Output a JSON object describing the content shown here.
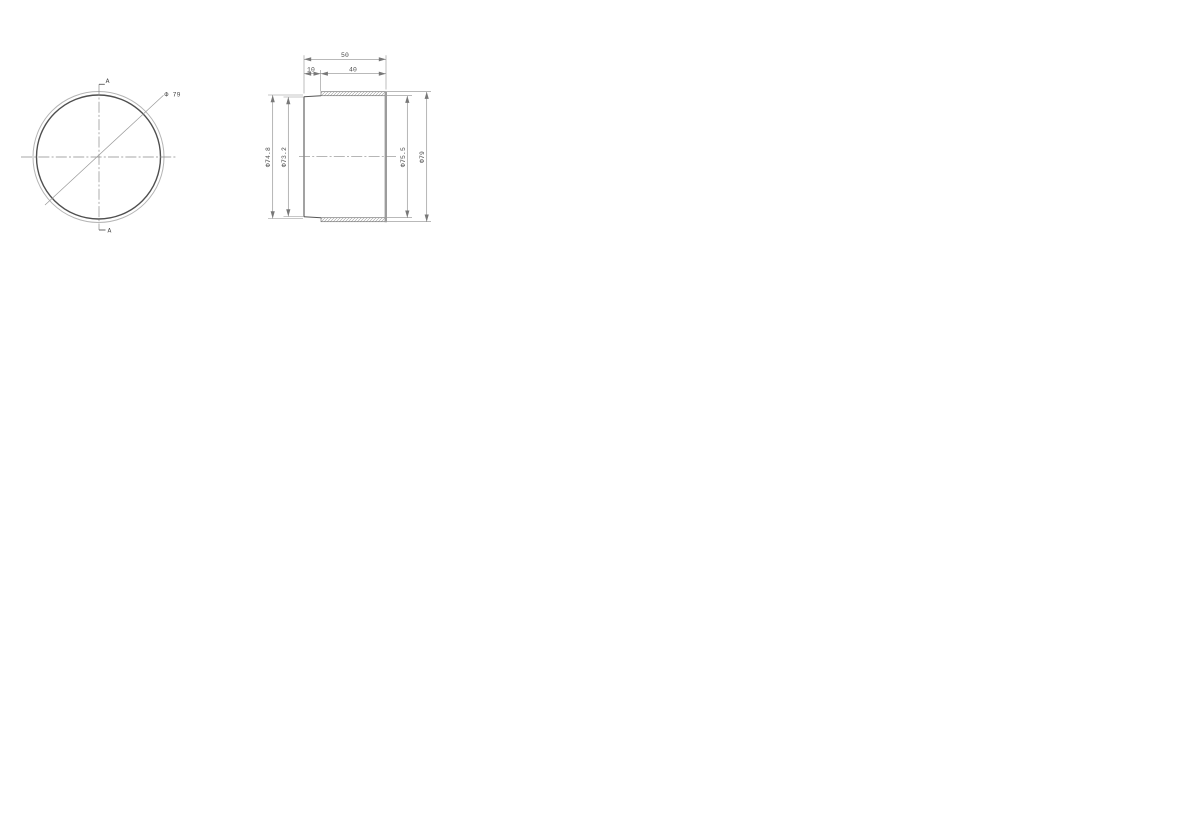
{
  "drawing": {
    "front_view": {
      "section_marker_top": "A",
      "section_marker_bottom": "A",
      "diameter_label": "Φ 79"
    },
    "section_view": {
      "length_total": "50",
      "length_lead": "10",
      "length_thread": "40",
      "dia_left_outer": "Φ74.8",
      "dia_left_inner": "Φ73.2",
      "dia_right_inner": "Φ75.5",
      "dia_right_outer": "Φ79"
    },
    "colors": {
      "background": "#ffffff",
      "object_line": "#555555",
      "light_line": "#b5b5b5",
      "thick_edge": "#9c9c9c",
      "dim_line": "#8f8f8f",
      "hatch_line": "#9a9a9a",
      "text": "#4a4a4a"
    }
  }
}
